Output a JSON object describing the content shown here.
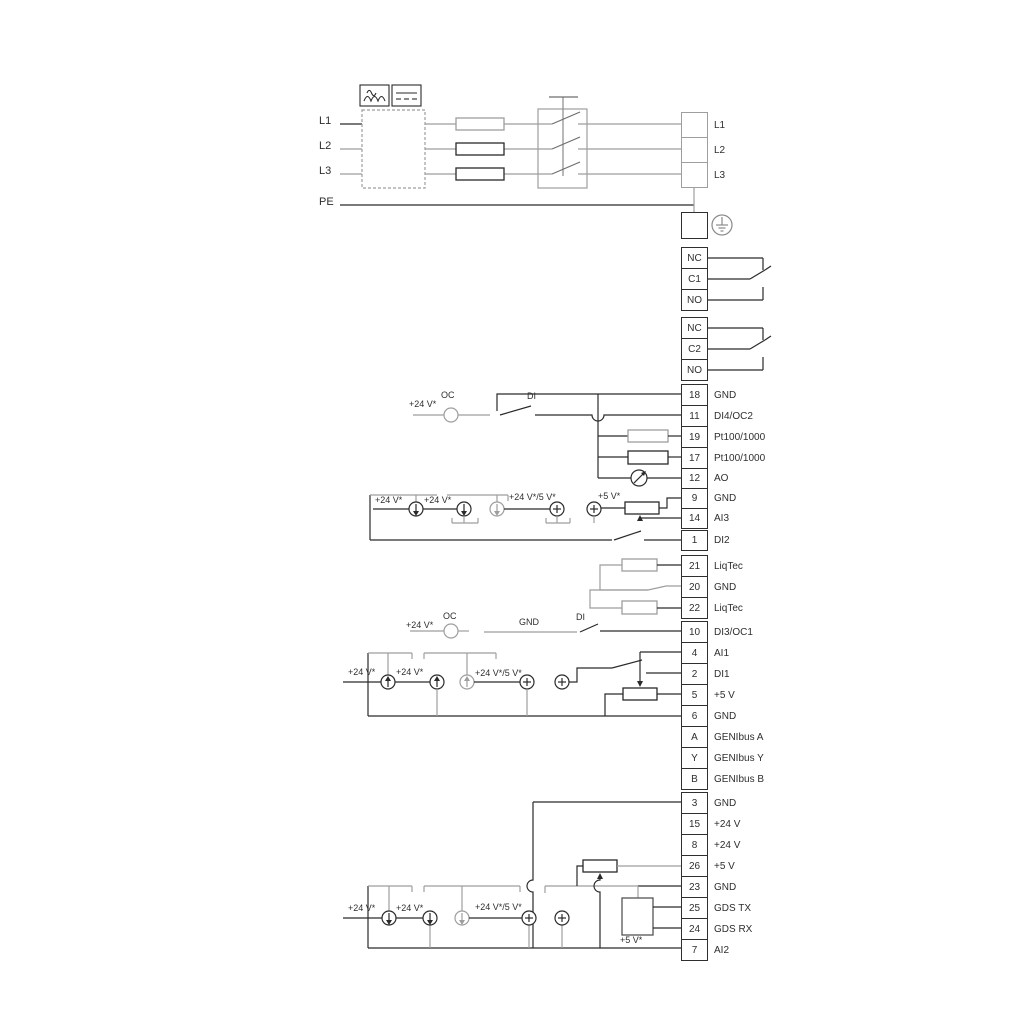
{
  "colors": {
    "wire_dark": "#2a2a2a",
    "wire_gray": "#9e9e9e",
    "background": "#ffffff",
    "text": "#2e2e2e"
  },
  "power_input": {
    "l1": "L1",
    "l2": "L2",
    "l3": "L3",
    "pe": "PE"
  },
  "power_output": {
    "l1": "L1",
    "l2": "L2",
    "l3": "L3"
  },
  "relay1": {
    "nc": "NC",
    "com": "C1",
    "no": "NO"
  },
  "relay2": {
    "nc": "NC",
    "com": "C2",
    "no": "NO"
  },
  "io": [
    {
      "num": "18",
      "label": "GND"
    },
    {
      "num": "11",
      "label": "DI4/OC2"
    },
    {
      "num": "19",
      "label": "Pt100/1000"
    },
    {
      "num": "17",
      "label": "Pt100/1000"
    },
    {
      "num": "12",
      "label": "AO"
    },
    {
      "num": "9",
      "label": "GND"
    },
    {
      "num": "14",
      "label": "AI3"
    },
    {
      "num": "1",
      "label": "DI2"
    },
    {
      "num": "21",
      "label": "LiqTec"
    },
    {
      "num": "20",
      "label": "GND"
    },
    {
      "num": "22",
      "label": "LiqTec"
    },
    {
      "num": "10",
      "label": "DI3/OC1"
    },
    {
      "num": "4",
      "label": "AI1"
    },
    {
      "num": "2",
      "label": "DI1"
    },
    {
      "num": "5",
      "label": "+5 V"
    },
    {
      "num": "6",
      "label": "GND"
    },
    {
      "num": "A",
      "label": "GENIbus A"
    },
    {
      "num": "Y",
      "label": "GENIbus Y"
    },
    {
      "num": "B",
      "label": "GENIbus B"
    },
    {
      "num": "3",
      "label": "GND"
    },
    {
      "num": "15",
      "label": "+24 V"
    },
    {
      "num": "8",
      "label": "+24 V"
    },
    {
      "num": "26",
      "label": "+5 V"
    },
    {
      "num": "23",
      "label": "GND"
    },
    {
      "num": "25",
      "label": "GDS TX"
    },
    {
      "num": "24",
      "label": "GDS RX"
    },
    {
      "num": "7",
      "label": "AI2"
    }
  ],
  "ann": {
    "v24": "+24 V*",
    "v24v5": "+24 V*/5 V*",
    "v5": "+5 V*",
    "oc": "OC",
    "di": "DI",
    "gnd": "GND"
  }
}
